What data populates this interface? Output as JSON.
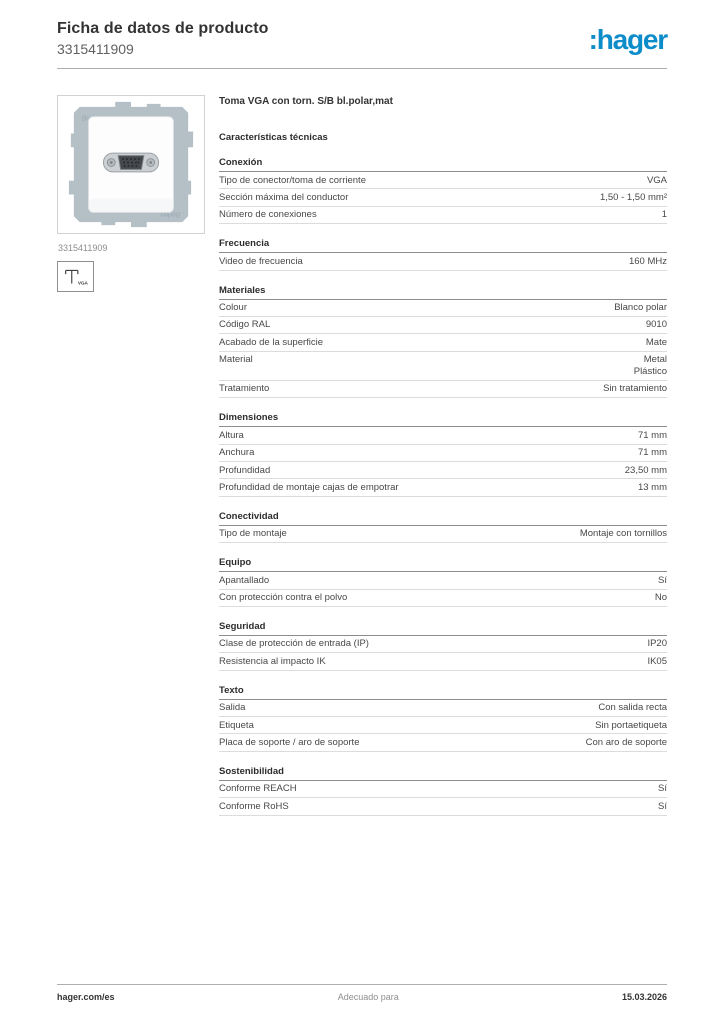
{
  "header": {
    "title": "Ficha de datos de producto",
    "product_number": "3315411909",
    "logo_text": ":hager",
    "brand_color": "#0d8cca"
  },
  "product": {
    "name": "Toma VGA con torn. S/B bl.polar,mat",
    "image_caption": "3315411909",
    "plate_watermark": "Berker",
    "icon_label": "VGA"
  },
  "table": {
    "heading": "Características técnicas",
    "sections": [
      {
        "title": "Conexión",
        "rows": [
          {
            "label": "Tipo de conector/toma de corriente",
            "value": "VGA"
          },
          {
            "label": "Sección máxima del conductor",
            "value": "1,50 - 1,50 mm²"
          },
          {
            "label": "Número de conexiones",
            "value": "1"
          }
        ]
      },
      {
        "title": "Frecuencia",
        "rows": [
          {
            "label": "Video de frecuencia",
            "value": "160 MHz"
          }
        ]
      },
      {
        "title": "Materiales",
        "rows": [
          {
            "label": "Colour",
            "value": "Blanco polar"
          },
          {
            "label": "Código RAL",
            "value": "9010"
          },
          {
            "label": "Acabado de la superficie",
            "value": "Mate"
          },
          {
            "label": "Material",
            "value": "Metal\nPlástico"
          },
          {
            "label": "Tratamiento",
            "value": "Sin tratamiento"
          }
        ]
      },
      {
        "title": "Dimensiones",
        "rows": [
          {
            "label": "Altura",
            "value": "71 mm"
          },
          {
            "label": "Anchura",
            "value": "71 mm"
          },
          {
            "label": "Profundidad",
            "value": "23,50 mm"
          },
          {
            "label": "Profundidad de montaje cajas de empotrar",
            "value": "13 mm"
          }
        ]
      },
      {
        "title": "Conectividad",
        "rows": [
          {
            "label": "Tipo de montaje",
            "value": "Montaje con tornillos"
          }
        ]
      },
      {
        "title": "Equipo",
        "rows": [
          {
            "label": "Apantallado",
            "value": "Sí"
          },
          {
            "label": "Con protección contra el polvo",
            "value": "No"
          }
        ]
      },
      {
        "title": "Seguridad",
        "rows": [
          {
            "label": "Clase de protección de entrada (IP)",
            "value": "IP20"
          },
          {
            "label": "Resistencia al impacto IK",
            "value": "IK05"
          }
        ]
      },
      {
        "title": "Texto",
        "rows": [
          {
            "label": "Salida",
            "value": "Con salida recta"
          },
          {
            "label": "Etiqueta",
            "value": "Sin portaetiqueta"
          },
          {
            "label": "Placa de soporte / aro de soporte",
            "value": "Con aro de soporte"
          }
        ]
      },
      {
        "title": "Sostenibilidad",
        "rows": [
          {
            "label": "Conforme REACH",
            "value": "Sí"
          },
          {
            "label": "Conforme RoHS",
            "value": "Sí"
          }
        ]
      }
    ]
  },
  "footer": {
    "left": "hager.com/es",
    "center": "Adecuado para",
    "right": "15.03.2026"
  }
}
